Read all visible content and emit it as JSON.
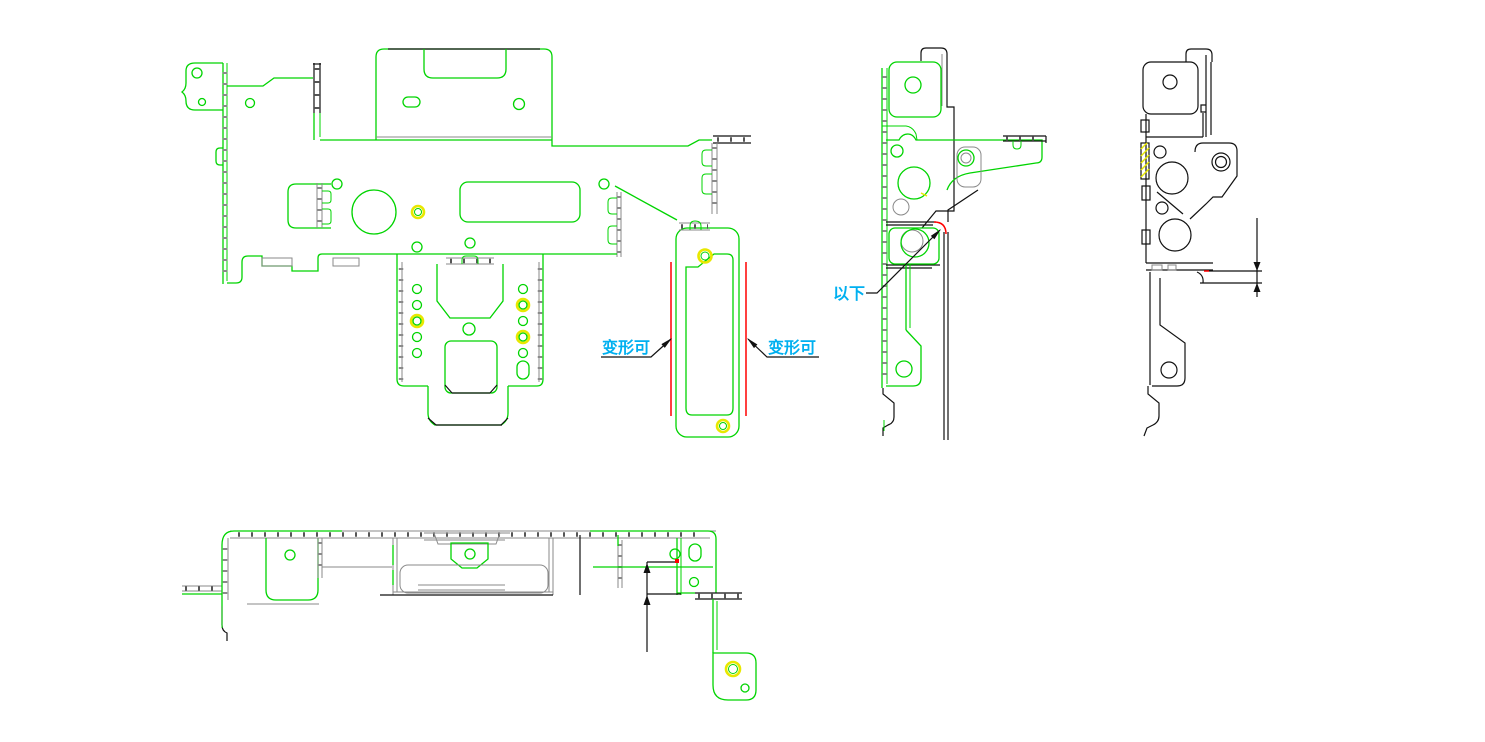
{
  "drawing": {
    "background": "#ffffff",
    "colors": {
      "part_outline_green": "#00d400",
      "edge_black": "#111111",
      "bend_gray": "#8a8a8a",
      "highlight_red": "#ff0000",
      "highlight_yellow": "#e8e800",
      "annotation_cyan": "#00b0f0"
    },
    "annotations": {
      "deform_left": {
        "text": "变形可"
      },
      "deform_right": {
        "text": "变形可"
      },
      "below": {
        "text": "以下"
      }
    }
  }
}
